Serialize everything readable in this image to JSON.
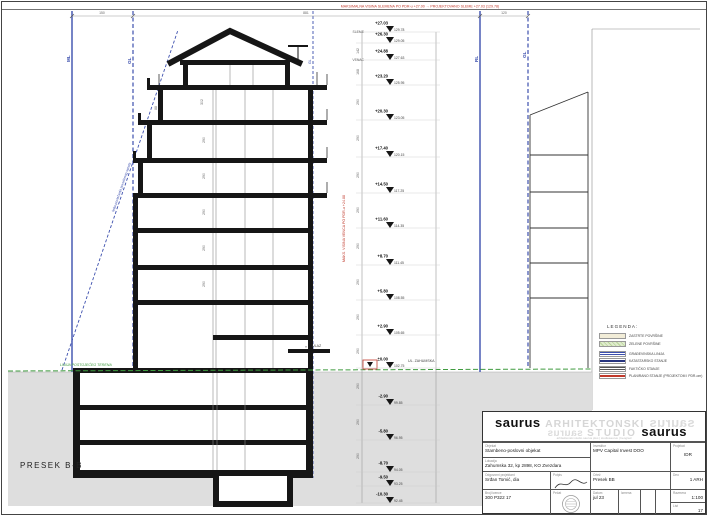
{
  "sheet": {
    "section_label": "PRESEK B-B"
  },
  "reglines": {
    "ml": "ML",
    "gl": "GL",
    "gl_back": "GL",
    "rl": "RL",
    "gl2": "GL"
  },
  "notes": {
    "red_top": "MAKSIMALNA VISINA SLEMENA PO PDR-u +27.00  →  PROJEKTOVANO SLEME +27.03 (129.78)",
    "red_side": "MAKS. VISINA VENCA PO PDR-u +24.88",
    "terrain": "LINIJA POSTOJEĆEG TERENA",
    "setback": "linija povlačenja povučenog sprata",
    "street": "UL. ZAHUMSKA",
    "entrance": "ULAZ",
    "entrance_chevron": "«",
    "sleme": "SLEME",
    "venac": "VENAC"
  },
  "elevations": [
    {
      "rel": "+27.03",
      "abs": "129.78"
    },
    {
      "rel": "+26.30",
      "abs": "129.05"
    },
    {
      "rel": "+24.88",
      "abs": "127.63"
    },
    {
      "rel": "+23.20",
      "abs": "125.95"
    },
    {
      "rel": "+20.30",
      "abs": "123.05"
    },
    {
      "rel": "+17.40",
      "abs": "120.15"
    },
    {
      "rel": "+14.50",
      "abs": "117.25"
    },
    {
      "rel": "+11.60",
      "abs": "114.35"
    },
    {
      "rel": "+8.70",
      "abs": "111.45"
    },
    {
      "rel": "+5.80",
      "abs": "108.55"
    },
    {
      "rel": "+2.90",
      "abs": "105.65"
    },
    {
      "rel": "±0.00",
      "abs": "102.75"
    },
    {
      "rel": "-2.90",
      "abs": "99.85"
    },
    {
      "rel": "-5.80",
      "abs": "96.95"
    },
    {
      "rel": "-8.70",
      "abs": "94.05"
    },
    {
      "rel": "-9.50",
      "abs": "93.25"
    },
    {
      "rel": "-10.30",
      "abs": "92.45"
    }
  ],
  "dims_left": [
    "142",
    "168",
    "290",
    "290",
    "290",
    "290",
    "290",
    "290",
    "290",
    "290",
    "290",
    "290",
    "290"
  ],
  "dims_top": [
    "150",
    "881",
    "120"
  ],
  "dims_interior": [
    "302",
    "88",
    "290",
    "290",
    "290",
    "290",
    "290"
  ],
  "legend": {
    "title": "LEGENDA:",
    "surfaces": [
      {
        "label": "ZASTRTE POVRŠINE",
        "color": "#f2edd8"
      },
      {
        "label": "ZELENE POVRŠINE",
        "color": "#dfeccd"
      }
    ],
    "lines": [
      {
        "label": "GRAĐEVINSKA LINIJA",
        "color": "#3c4fae"
      },
      {
        "label": "KATASTARSKO STANJE",
        "color": "#27357f"
      },
      {
        "label": "FAKTIČKO STANJE",
        "color": "#555555"
      },
      {
        "label": "PLANIRANO STANJE (PROJEKTOM I PDR-om)",
        "color": "#c0392b"
      }
    ]
  },
  "titleblock": {
    "logo": {
      "brand": "saurus",
      "brand_outline": "ARHITEKTONSKI",
      "brand_mirror": "saurus",
      "studio": "STUDIO",
      "brand2": "saurus",
      "caption": "arhitektonski studio saurus plus | studiosaurus | beograd"
    },
    "objekat_label": "Objekat",
    "objekat": "Stambeno-poslovni objekat",
    "lokacija_label": "Lokacija",
    "lokacija": "Zahumska 32, kp 2898, KO Zvezdara",
    "investitor_label": "Investitor",
    "investitor": "MPV Capital Invest DOO",
    "projekat_label": "Projekat",
    "projekat": "IDR",
    "odg_label": "Odgovorni projektant",
    "odg": "Srđan Tomić, dia",
    "potpis_label": "Potpis",
    "crtez_label": "Crtež",
    "crtez": "Presek BB",
    "deo_label": "Deo",
    "deo": "1 ARH",
    "licenca_label": "Broj licence",
    "licenca": "300 P322 17",
    "pecat_label": "Pečat",
    "datum_label": "Datum",
    "datum": "jul 23",
    "izmena_label": "Izmena",
    "razmera_label": "Razmera",
    "razmera": "1:100",
    "list_label": "List",
    "list": "17"
  }
}
